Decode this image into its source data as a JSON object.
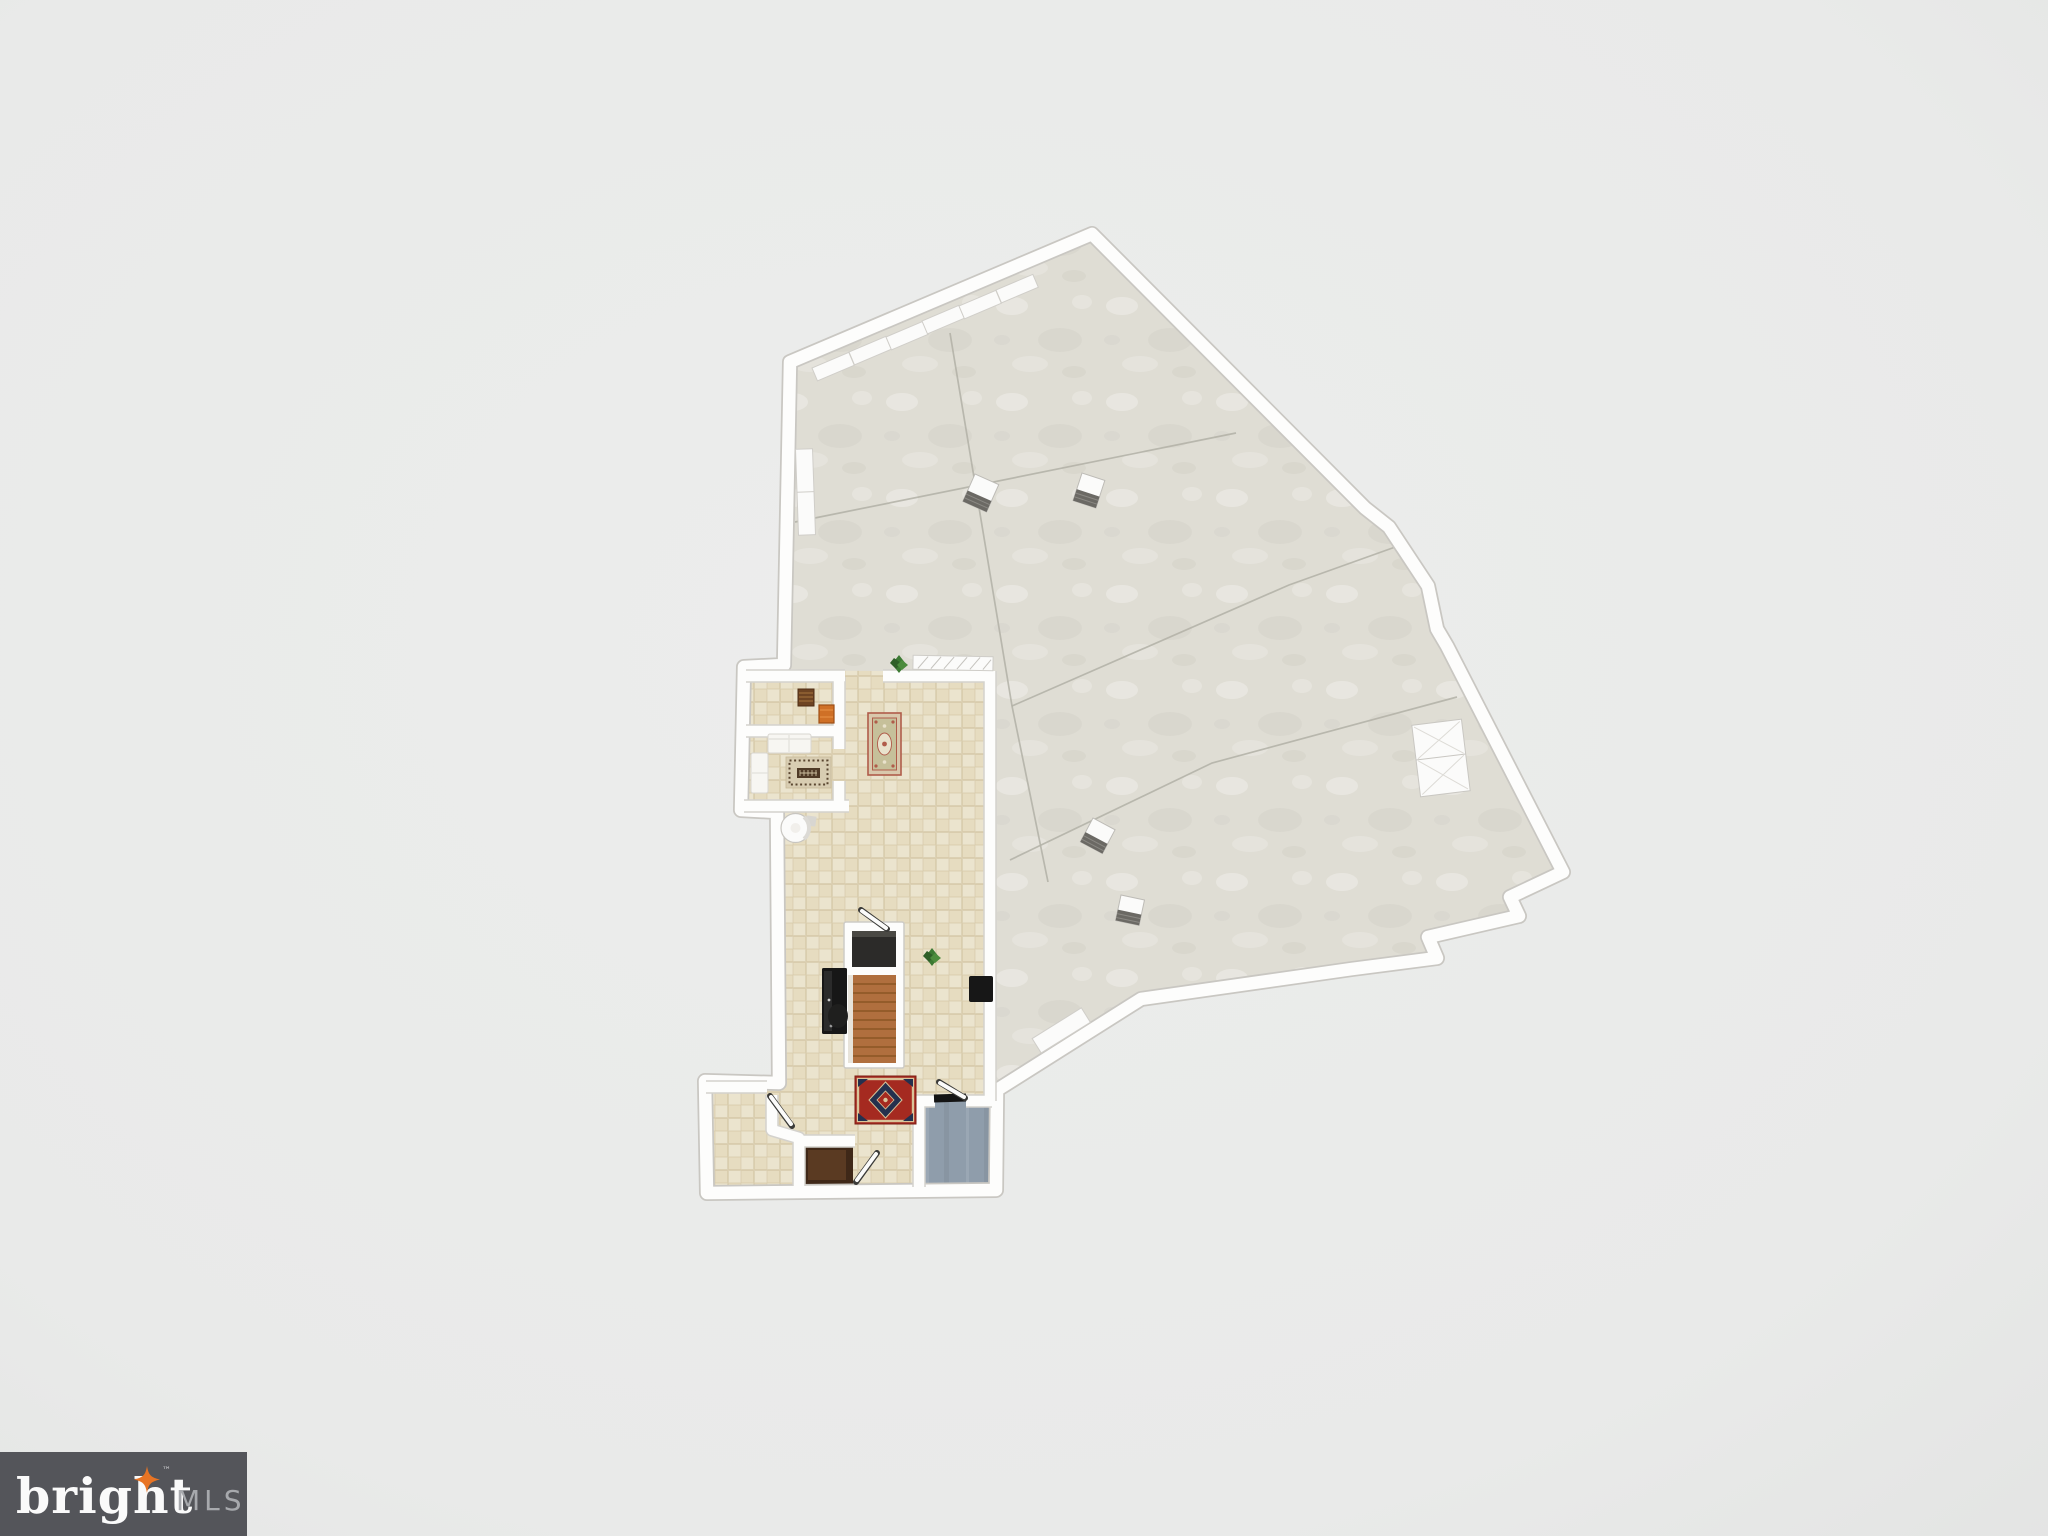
{
  "logo": {
    "brand": "bright",
    "tm": "™",
    "suffix": "MLS"
  },
  "colors": {
    "background": "#e9eae9",
    "background_edge": "#e3e4e3",
    "wall": "#fdfdfc",
    "wall_shadow": "#c9c7c2",
    "concrete_floor": "#dfddd4",
    "concrete_seam": "#b2b0a6",
    "tile_floor": "#e6dcc0",
    "blue_floor": "#8f9dab",
    "closet_wood_dark": "#3f2818",
    "closet_wood_light": "#5a3a22",
    "stair_wood": "#b06f3e",
    "stair_void": "#2c2b29",
    "furniture_black": "#171717",
    "sofa_white": "#f7f6f2",
    "rug_red_field": "#a52a20",
    "rug_red_border": "#d9c49a",
    "rug_red_medallion": "#24304e",
    "rug_ornate_border": "#d9c8ac",
    "rug_ornate_field": "#c6c09a",
    "rug_ornate_accent": "#b05c4a",
    "rug_beige": "#d8cdb2",
    "rug_beige_dark": "#4f3a26",
    "chest_brown": "#6e4423",
    "crate_orange": "#cf7026",
    "plant_green": "#3c7a33",
    "box_white_top": "#fbfbfa",
    "box_gray_side": "#6b6964",
    "logo_bg": "#54555a",
    "logo_text": "#fafafa",
    "logo_star": "#e87424",
    "logo_mls": "#a7a9ad"
  }
}
